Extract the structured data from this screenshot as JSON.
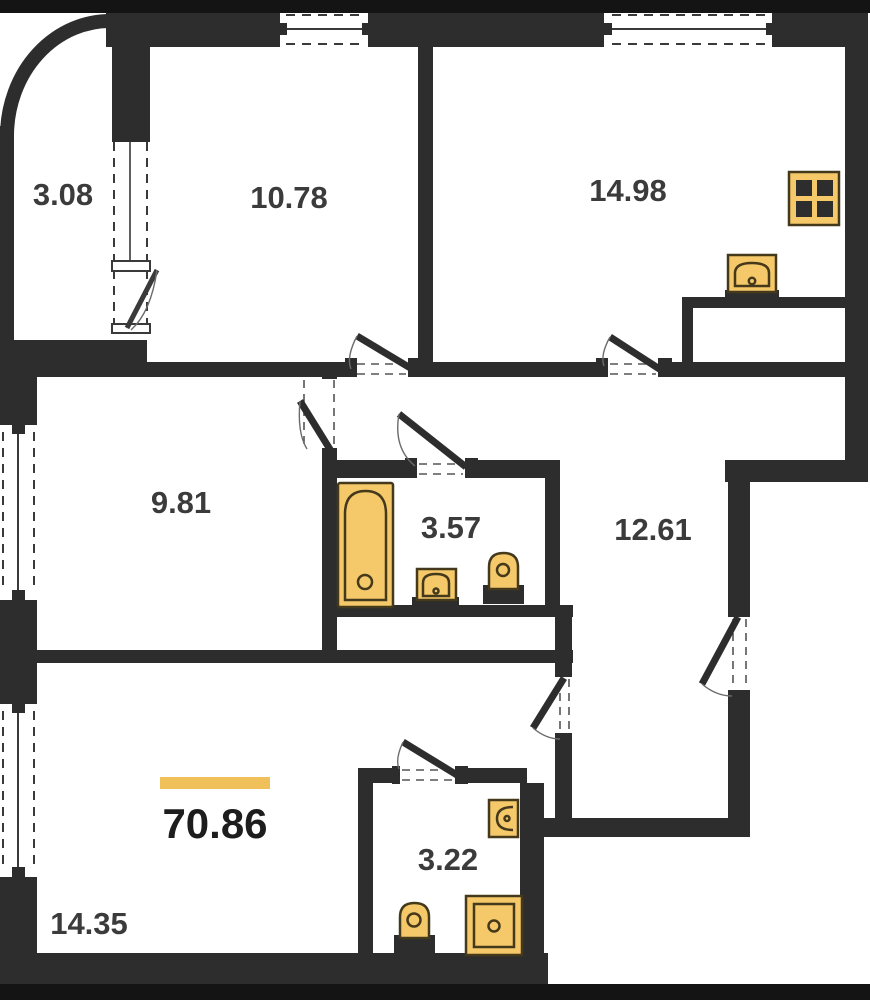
{
  "plan": {
    "type": "apartment-floor-plan",
    "total_area_label": "70.86",
    "rooms": {
      "balcony": {
        "area": "3.08"
      },
      "bedroom_top": {
        "area": "10.78"
      },
      "kitchen": {
        "area": "14.98"
      },
      "bedroom_left": {
        "area": "9.81"
      },
      "bathroom": {
        "area": "3.57"
      },
      "hallway": {
        "area": "12.61"
      },
      "wc": {
        "area": "3.22"
      },
      "living_room": {
        "area": "14.35"
      }
    },
    "icons": {
      "stove": "stove-icon",
      "kitchen_sink": "sink-icon",
      "bathtub": "bathtub-icon",
      "bathroom_sink": "sink-icon",
      "bathroom_toilet": "toilet-icon",
      "wc_sink": "sink-icon",
      "wc_toilet": "toilet-icon",
      "wc_shower": "shower-icon"
    },
    "colors": {
      "wall": "#2d2d2d",
      "fixture_fill": "#f5c869",
      "fixture_stroke": "#45391c",
      "accent_bar": "#f0c05a",
      "label_text": "#3b3b3b",
      "background": "#ffffff",
      "frame_bar": "#141414"
    }
  }
}
